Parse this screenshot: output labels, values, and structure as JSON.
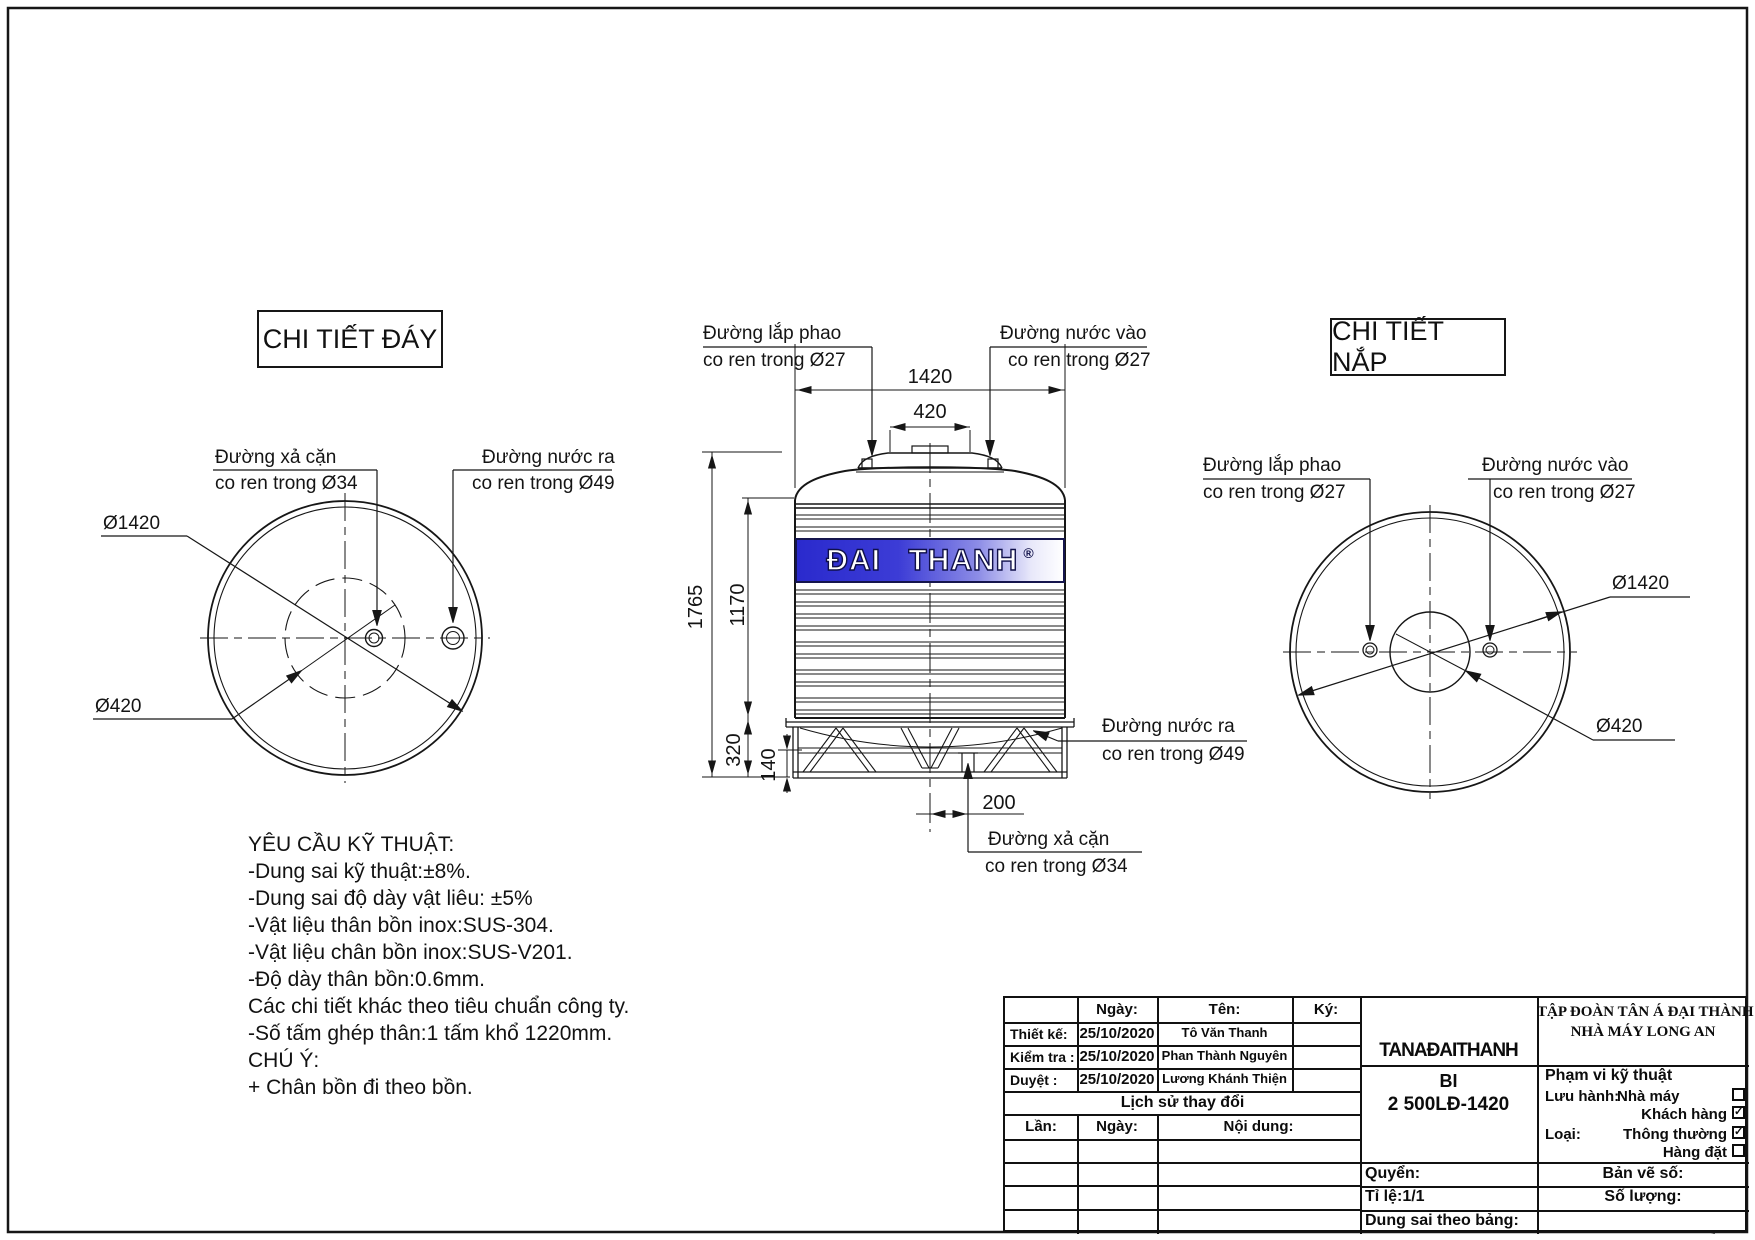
{
  "views": {
    "bottom": {
      "title": "CHI TIẾT ĐÁY",
      "drain_line1": "Đường xả cặn",
      "drain_line2": "co ren trong Ø34",
      "outlet_line1": "Đường nước ra",
      "outlet_line2": "co ren trong Ø49",
      "dia_outer": "Ø1420",
      "dia_inner": "Ø420"
    },
    "side": {
      "float_line1": "Đường lắp phao",
      "float_line2": "co ren trong Ø27",
      "inlet_line1": "Đường nước vào",
      "inlet_line2": "co ren trong Ø27",
      "outlet_line1": "Đường nước ra",
      "outlet_line2": "co ren trong Ø49",
      "drain_line1": "Đường xả cặn",
      "drain_line2": "co ren trong Ø34",
      "dims": {
        "width": "1420",
        "cap": "420",
        "total_height": "1765",
        "body_height": "1170",
        "stand_height": "320",
        "stand_lower": "140",
        "drain_offset": "200"
      },
      "brand": "ĐAI THANH",
      "registered": "®",
      "band_color": "#2a2acd"
    },
    "lid": {
      "title": "CHI TIẾT NẮP",
      "float_line1": "Đường lắp phao",
      "float_line2": "co ren trong Ø27",
      "inlet_line1": "Đường nước vào",
      "inlet_line2": "co ren trong Ø27",
      "dia_outer": "Ø1420",
      "dia_inner": "Ø420"
    }
  },
  "notes": {
    "lines": [
      "YÊU CẦU KỸ THUẬT:",
      "-Dung sai kỹ thuật:±8%.",
      "-Dung sai độ dày vật liêu: ±5%",
      "-Vật liệu thân bồn inox:SUS-304.",
      "-Vật liệu chân bồn inox:SUS-V201.",
      "-Độ dày thân bồn:0.6mm.",
      "Các chi tiết khác theo tiêu chuẩn công ty.",
      "-Số tấm ghép thân:1 tấm khổ 1220mm.",
      "CHÚ Ý:",
      "+ Chân bồn đi theo bồn."
    ]
  },
  "title_block": {
    "headers": {
      "date": "Ngày:",
      "name": "Tên:",
      "sign": "Ký:"
    },
    "rows": [
      {
        "label": "Thiết kế:",
        "date": "25/10/2020",
        "name": "Tô Văn Thanh"
      },
      {
        "label": "Kiểm tra :",
        "date": "25/10/2020",
        "name": "Phan Thành Nguyên"
      },
      {
        "label": "Duyệt :",
        "date": "25/10/2020",
        "name": "Lương Khánh Thiện"
      }
    ],
    "history_title": "Lịch sử thay đổi",
    "history_headers": {
      "lan": "Lần:",
      "ngay": "Ngày:",
      "noidung": "Nội dung:"
    },
    "brand_mark": "TANAĐAITHANH",
    "company_line1": "TẬP ĐOÀN TÂN Á ĐẠI THÀNH",
    "company_line2": "NHÀ MÁY LONG AN",
    "model_line1": "BI",
    "model_line2": "2 500LĐ-1420",
    "scope_title": "Phạm vi kỹ thuật",
    "fields": {
      "luu_hanh": "Lưu hành:",
      "nha_may": "Nhà máy",
      "khach_hang": "Khách hàng",
      "loai": "Loại:",
      "thong_thuong": "Thông thường",
      "hang_dat": "Hàng đặt",
      "quyen": "Quyển:",
      "ban_ve_so": "Bản vẽ số:",
      "ti_le": "Tỉ lệ:1/1",
      "so_luong": "Số lượng:",
      "dung_sai": "Dung sai theo bảng:"
    },
    "checks": {
      "nha_may": "",
      "khach_hang": "✓",
      "thong_thuong": "✓",
      "hang_dat": ""
    }
  }
}
